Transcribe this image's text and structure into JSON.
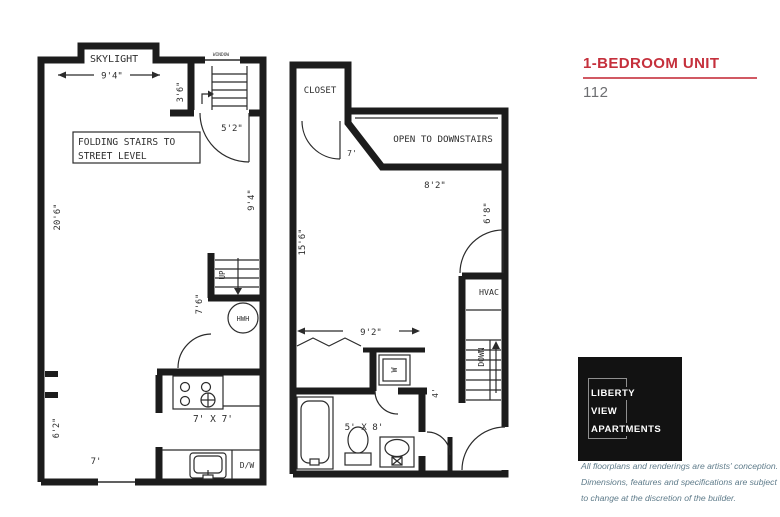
{
  "panel": {
    "title": "1-BEDROOM UNIT",
    "unit_number": "112",
    "accent_color": "#c5303c",
    "logo": {
      "line1": "LIBERTY",
      "line2": "VIEW",
      "line3": "APARTMENTS"
    },
    "disclaimer": {
      "line1": "All floorplans and renderings are artists' conception.",
      "line2": "Dimensions, features and specifications are subject",
      "line3": "to change at the discretion of the builder."
    }
  },
  "plan_left": {
    "labels": {
      "window": "WINDOW",
      "skylight": "SKYLIGHT",
      "skylight_width": "9'4\"",
      "stair_depth": "3'6\"",
      "stair_width": "5'2\"",
      "entry_side": "9'4\"",
      "folding_line1": "FOLDING STAIRS TO",
      "folding_line2": "STREET LEVEL",
      "room_length": "20'6\"",
      "up": "UP",
      "hall_width": "7'6\"",
      "hwh": "HWH",
      "kitchen_size": "7' X 7'",
      "window_width": "7'",
      "wall_width": "6'2\"",
      "dishwasher": "D/W"
    }
  },
  "plan_right": {
    "labels": {
      "closet": "CLOSET",
      "open_to_downstairs": "OPEN TO DOWNSTAIRS",
      "landing_width": "7'",
      "opening_width": "8'2\"",
      "room_length": "15'6\"",
      "room_width_right": "6'8\"",
      "hvac": "HVAC",
      "down": "DOWN",
      "bedroom_width": "9'2\"",
      "washer": "W",
      "hall_width": "4'",
      "bath_size": "5' X 8'"
    }
  }
}
